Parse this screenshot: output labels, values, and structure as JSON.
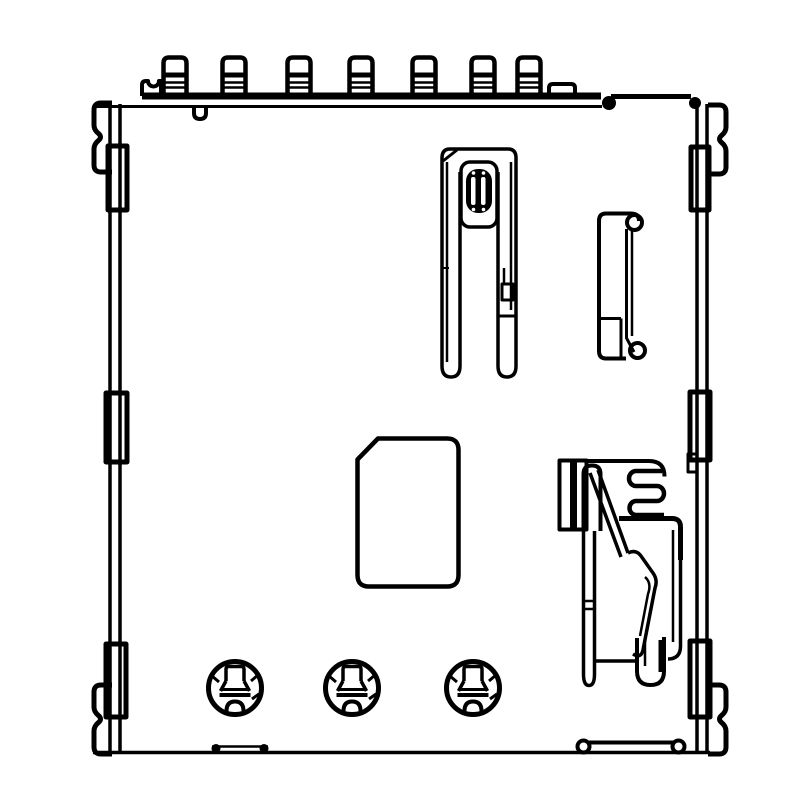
{
  "document": {
    "type": "technical-line-drawing",
    "description": "Monochrome engineering line drawing of a push-type SIM / memory card connector seen from above: seven solder terminal pins along the top edge, wavy side mounting tabs and edge solder pads on the left and right sides, a card-detect switch with striped plunger at top center, a small guide bracket on the right, a chamfered card pocket outline in the center, a coil-spring eject mechanism at the lower right, and three riveted contact circles along the bottom.",
    "background_color": "#ffffff",
    "line_color": "#000000"
  },
  "drawing": {
    "parts": [
      {
        "name": "connector-body",
        "label": "Connector body outline"
      },
      {
        "name": "top-terminal-pins",
        "label": "Top solder terminal pins",
        "count": 7
      },
      {
        "name": "side-mount-tabs",
        "label": "Wavy side mounting tabs",
        "count": 4
      },
      {
        "name": "side-edge-pads",
        "label": "Side edge solder pads",
        "count": 6
      },
      {
        "name": "card-detect-switch",
        "label": "Card detect switch with striped plunger"
      },
      {
        "name": "guide-bracket",
        "label": "Guide bracket with rolled ends"
      },
      {
        "name": "card-outline",
        "label": "Chamfered card pocket outline"
      },
      {
        "name": "eject-spring-mechanism",
        "label": "Coil-spring eject mechanism"
      },
      {
        "name": "bottom-contact-rivets",
        "label": "Bottom contact rivets",
        "count": 3
      },
      {
        "name": "bottom-solder-bar",
        "label": "Bottom solder bar with ring bumps"
      }
    ]
  }
}
